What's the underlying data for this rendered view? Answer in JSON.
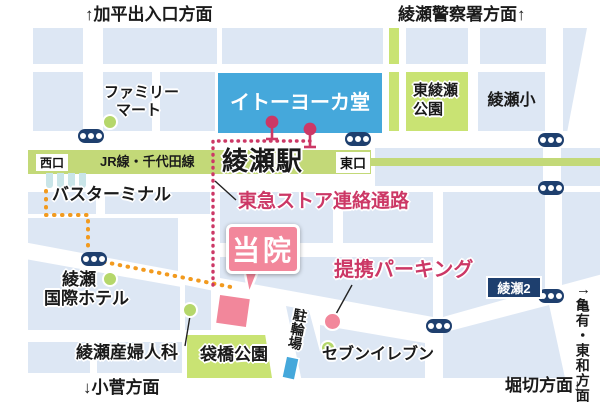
{
  "directions": {
    "kahei": "↑加平出入口方面",
    "police": "綾瀬警察署方面↑",
    "kosuge": "↓小菅方面",
    "horikiri": "堀切方面↓",
    "kameari_arrow": "→",
    "kameari": "亀有・東和方面"
  },
  "station": {
    "name": "綾瀬駅",
    "line": "JR線・千代田線",
    "west_exit": "西口",
    "east_exit": "東口"
  },
  "places": {
    "family_mart_line1": "ファミリー",
    "family_mart_line2": "マート",
    "ito_yokado": "イトーヨーカ堂",
    "higashi_ayase_park_line1": "東綾瀬",
    "higashi_ayase_park_line2": "公園",
    "ayase_elementary": "綾瀬小",
    "bus_terminal": "バスターミナル",
    "hotel_line1": "綾瀬",
    "hotel_line2": "国際ホテル",
    "obgyn": "綾瀬産婦人科",
    "fukurobashi_park": "袋橋公園",
    "bicycle_parking": "駐輪場",
    "seven_eleven": "セブンイレブン",
    "ayase2_block": "綾瀬2"
  },
  "markers": {
    "clinic": "当院",
    "passage": "東急ストア連絡通路",
    "partner_parking": "提携パーキング"
  },
  "colors": {
    "block": "#dde7f4",
    "road": "#ffffff",
    "rail": "#c3d978",
    "park": "#c9e373",
    "ito_blue": "#45a8db",
    "navy": "#1e3f6e",
    "pink": "#f2879b",
    "crimson": "#cc3866",
    "orange": "#f29a1e",
    "teal": "#c9e5e8",
    "dot_green": "#b5d76b"
  }
}
